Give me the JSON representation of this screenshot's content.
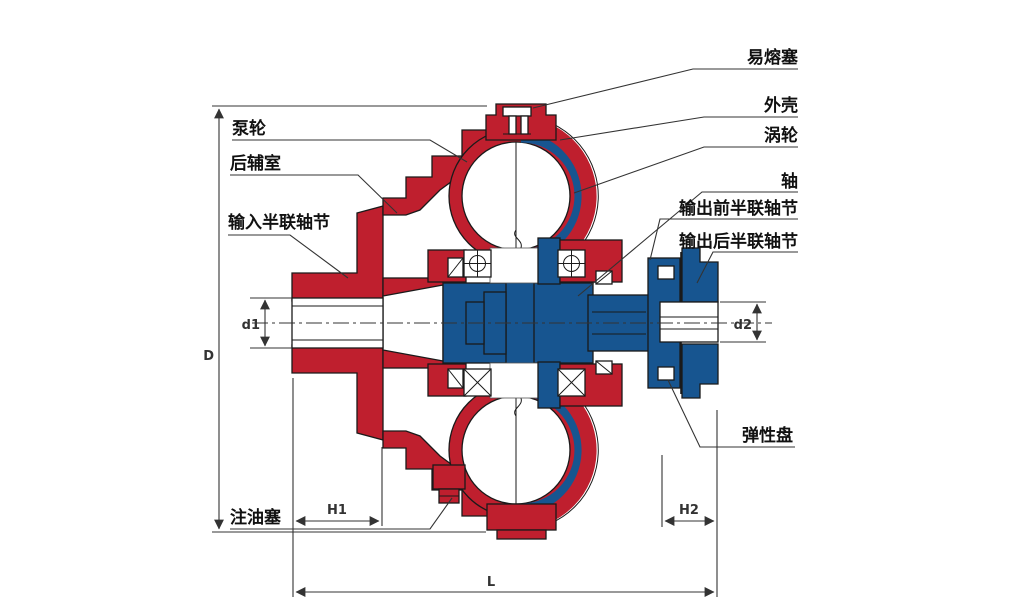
{
  "diagram": {
    "type": "fluid-coupling-cross-section",
    "parts": {
      "pump_wheel": "泵轮",
      "rear_chamber": "后辅室",
      "input_half_coupling": "输入半联轴节",
      "oil_plug": "注油塞",
      "fusible_plug": "易熔塞",
      "shell": "外壳",
      "turbine": "涡轮",
      "shaft": "轴",
      "output_front_half_coupling": "输出前半联轴节",
      "output_rear_half_coupling": "输出后半联轴节",
      "elastic_disc": "弹性盘"
    },
    "dims": {
      "D": "D",
      "d1": "d1",
      "d2": "d2",
      "H1": "H1",
      "H2": "H2",
      "L": "L"
    },
    "colors": {
      "pump_red": "#bf1f2e",
      "turbine_blue": "#175590",
      "outline": "#1a1a1a",
      "dimension_line": "#333333",
      "background": "#ffffff"
    }
  }
}
